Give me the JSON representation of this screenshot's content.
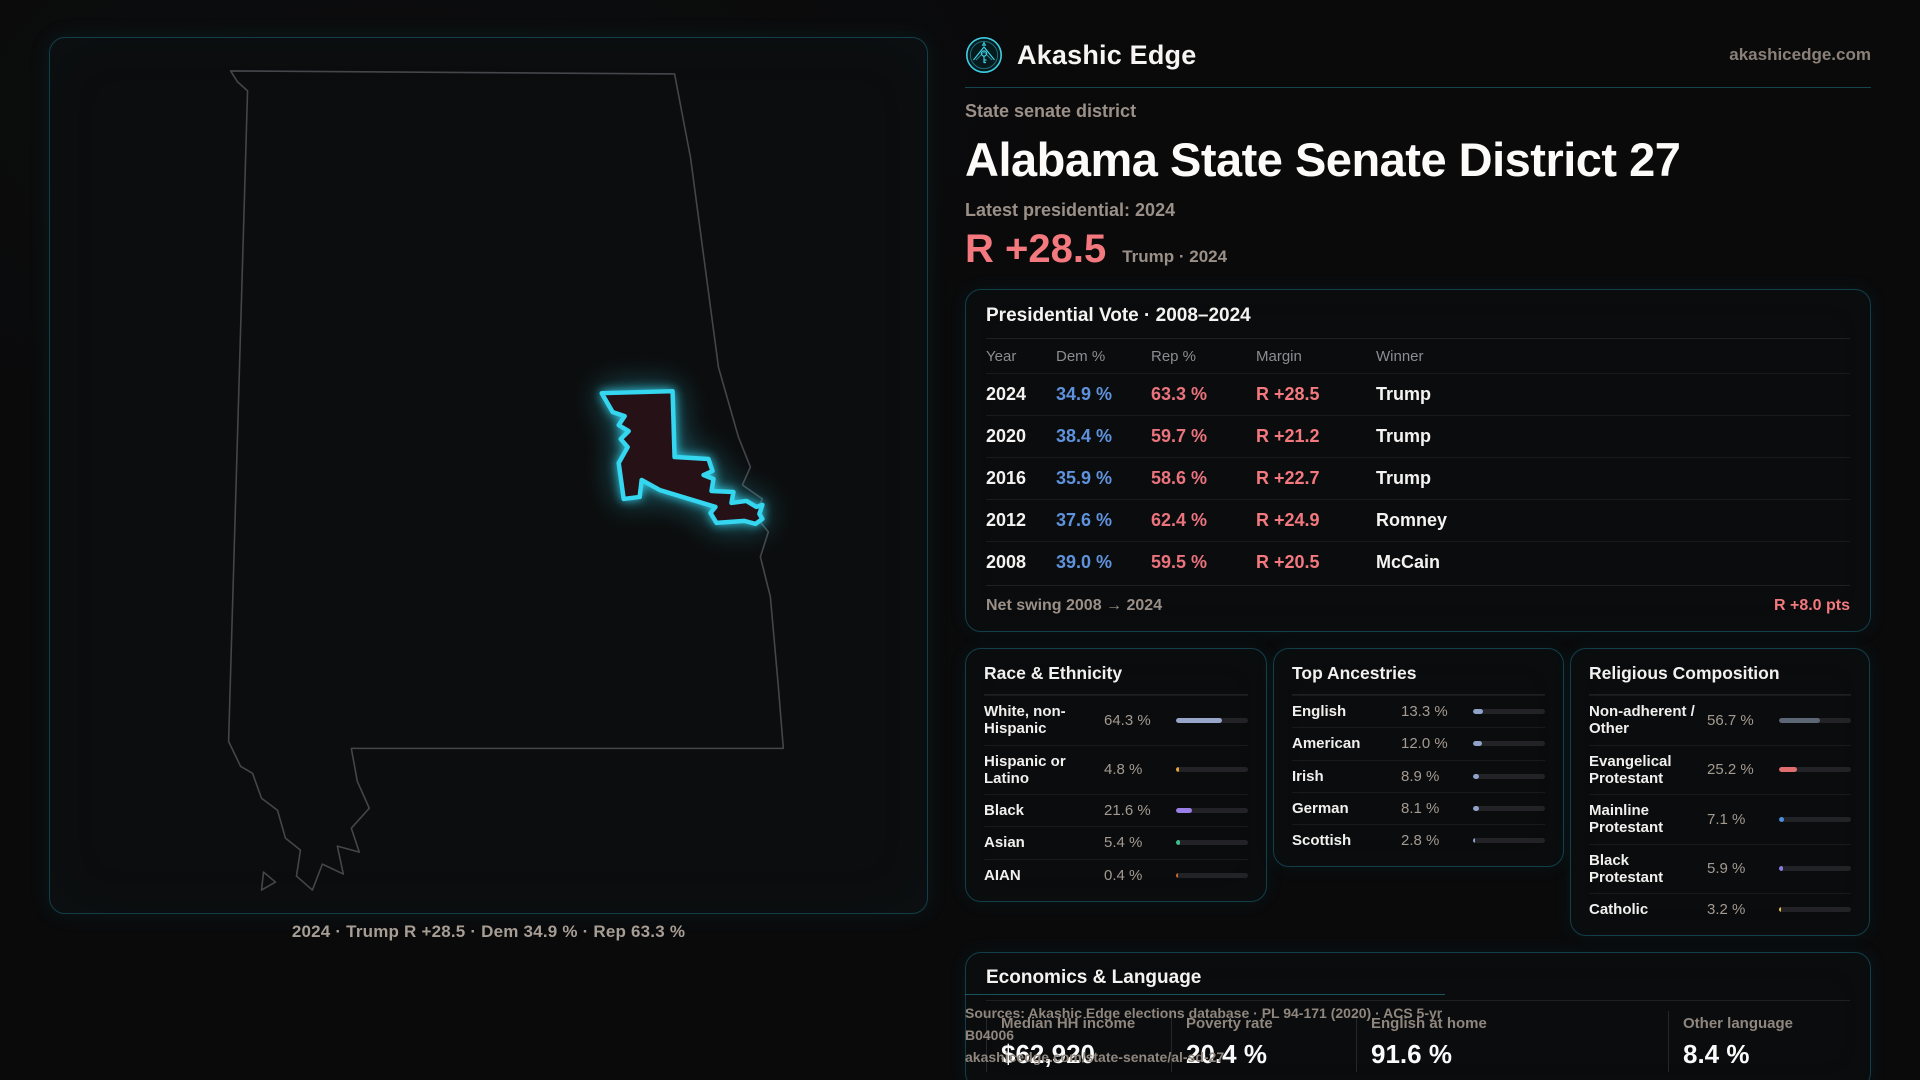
{
  "colors": {
    "accent_teal": "#35d6f0",
    "dem_blue": "#5f92dd",
    "rep_red": "#ea737d",
    "margin_red": "#f3797f",
    "district_fill": "#261216"
  },
  "brand": {
    "name": "Akashic Edge",
    "domain": "akashicedge.com",
    "logo_icon": "winged-key-emblem-icon"
  },
  "header": {
    "kicker": "State senate district",
    "title": "Alabama State Senate District 27",
    "subtitle": "Latest presidential: 2024",
    "margin_value": "R +28.5",
    "margin_context": "Trump · 2024"
  },
  "map": {
    "caption": "2024 · Trump R +28.5 · Dem 34.9 % · Rep 63.3 %",
    "highlight": "Senate District 27 outline on Alabama state map"
  },
  "presidential_table": {
    "title": "Presidential Vote · 2008–2024",
    "columns": [
      "Year",
      "Dem %",
      "Rep %",
      "Margin",
      "Winner"
    ],
    "rows": [
      {
        "year": "2024",
        "dem": "34.9 %",
        "rep": "63.3 %",
        "margin": "R +28.5",
        "winner": "Trump"
      },
      {
        "year": "2020",
        "dem": "38.4 %",
        "rep": "59.7 %",
        "margin": "R +21.2",
        "winner": "Trump"
      },
      {
        "year": "2016",
        "dem": "35.9 %",
        "rep": "58.6 %",
        "margin": "R +22.7",
        "winner": "Trump"
      },
      {
        "year": "2012",
        "dem": "37.6 %",
        "rep": "62.4 %",
        "margin": "R +24.9",
        "winner": "Romney"
      },
      {
        "year": "2008",
        "dem": "39.0 %",
        "rep": "59.5 %",
        "margin": "R +20.5",
        "winner": "McCain"
      }
    ],
    "footer_label": "Net swing 2008 → 2024",
    "footer_value": "R +8.0 pts"
  },
  "demographics": [
    {
      "title": "Race & Ethnicity",
      "items": [
        {
          "label": "White, non-Hispanic",
          "value": "64.3 %",
          "pct": 64.3,
          "color": "#97a6c9"
        },
        {
          "label": "Hispanic or Latino",
          "value": "4.8 %",
          "pct": 4.8,
          "color": "#e0a33e"
        },
        {
          "label": "Black",
          "value": "21.6 %",
          "pct": 21.6,
          "color": "#9a7fe6"
        },
        {
          "label": "Asian",
          "value": "5.4 %",
          "pct": 5.4,
          "color": "#3cc08d"
        },
        {
          "label": "AIAN",
          "value": "0.4 %",
          "pct": 0.4,
          "color": "#c96a2e"
        }
      ]
    },
    {
      "title": "Top Ancestries",
      "items": [
        {
          "label": "English",
          "value": "13.3 %",
          "pct": 13.3,
          "color": "#8fa3c8"
        },
        {
          "label": "American",
          "value": "12.0 %",
          "pct": 12.0,
          "color": "#8fa3c8"
        },
        {
          "label": "Irish",
          "value": "8.9 %",
          "pct": 8.9,
          "color": "#8fa3c8"
        },
        {
          "label": "German",
          "value": "8.1 %",
          "pct": 8.1,
          "color": "#8fa3c8"
        },
        {
          "label": "Scottish",
          "value": "2.8 %",
          "pct": 2.8,
          "color": "#8fa3c8"
        }
      ]
    },
    {
      "title": "Religious Composition",
      "items": [
        {
          "label": "Non-adherent / Other",
          "value": "56.7 %",
          "pct": 56.7,
          "color": "#5d6675"
        },
        {
          "label": "Evangelical Protestant",
          "value": "25.2 %",
          "pct": 25.2,
          "color": "#e06e6e"
        },
        {
          "label": "Mainline Protestant",
          "value": "7.1 %",
          "pct": 7.1,
          "color": "#4a90e2"
        },
        {
          "label": "Black Protestant",
          "value": "5.9 %",
          "pct": 5.9,
          "color": "#8d7ae3"
        },
        {
          "label": "Catholic",
          "value": "3.2 %",
          "pct": 3.2,
          "color": "#e3c23f"
        }
      ]
    }
  ],
  "economics": {
    "title": "Economics & Language",
    "stats": [
      {
        "label": "Median HH income",
        "value": "$62,920"
      },
      {
        "label": "Poverty rate",
        "value": "20.4 %"
      },
      {
        "label": "English at home",
        "value": "91.6 %"
      },
      {
        "label": "Other language",
        "value": "8.4 %"
      }
    ]
  },
  "sources": {
    "line1": "Sources: Akashic Edge elections database · PL 94-171 (2020) · ACS 5-yr B04006",
    "line2": "akashicedge.com/state-senate/al-sd-27"
  }
}
